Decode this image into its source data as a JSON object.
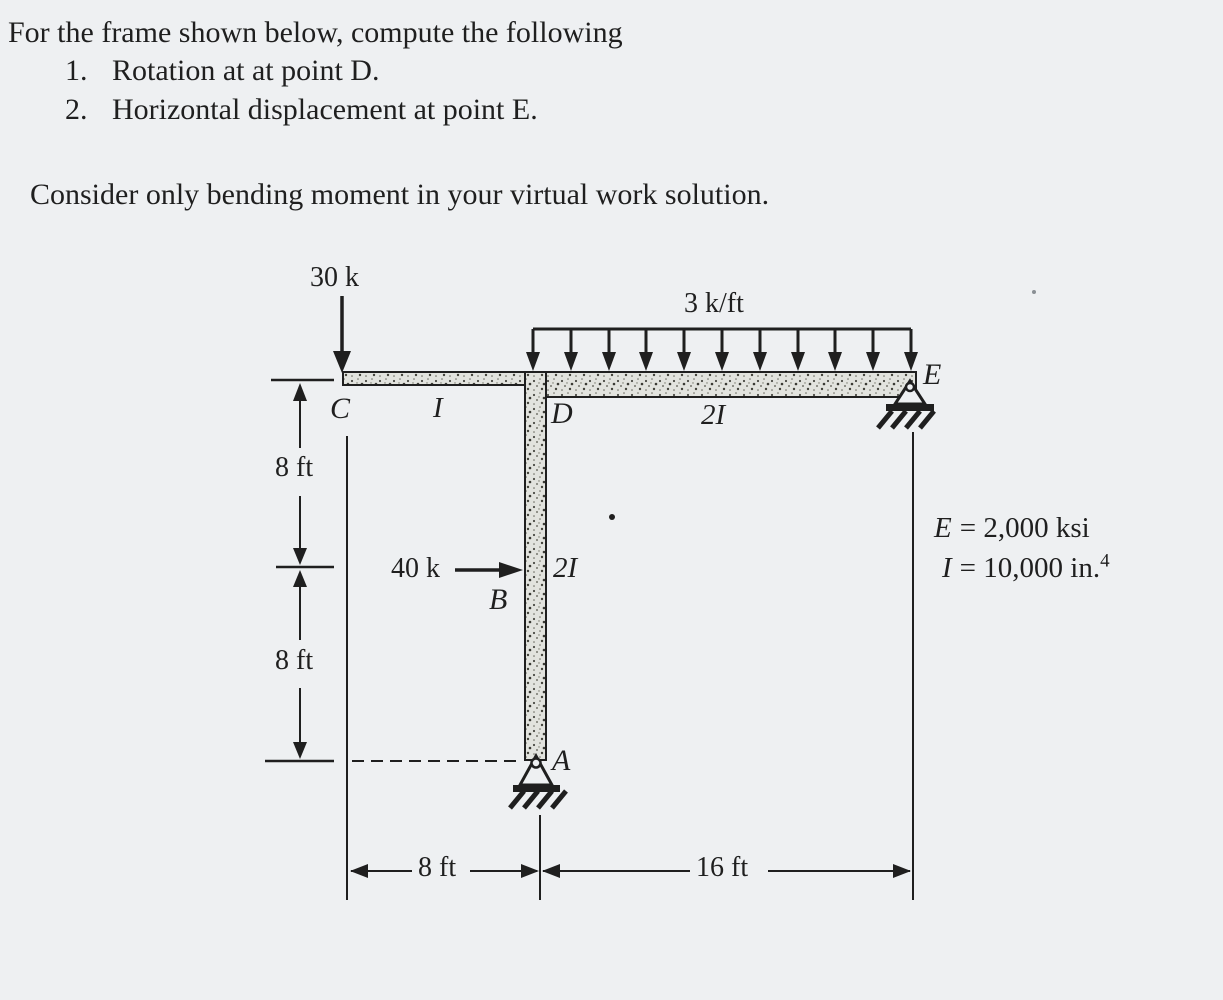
{
  "problem": {
    "intro": "For the frame shown below, compute the following",
    "items": [
      {
        "num": "1.",
        "text": "Rotation at at point D."
      },
      {
        "num": "2.",
        "text": "Horizontal displacement at point E."
      }
    ],
    "note": "Consider only bending moment in your virtual work solution."
  },
  "diagram": {
    "loads": {
      "top_point": "30 k",
      "distributed": "3 k/ft",
      "side_point": "40 k"
    },
    "nodes": {
      "c": "C",
      "d": "D",
      "e": "E",
      "b": "B",
      "a": "A"
    },
    "members": {
      "beam_left": "I",
      "beam_right": "2I",
      "column": "2I"
    },
    "dims": {
      "left_upper": "8 ft",
      "left_lower": "8 ft",
      "bottom_left": "8 ft",
      "bottom_right": "16 ft"
    },
    "properties": {
      "modulus_symbol": "E",
      "modulus_text": "= 2,000 ksi",
      "inertia_symbol": "I",
      "inertia_text": "= 10,000 in.",
      "inertia_sup": "4"
    },
    "colors": {
      "ink": "#1f1f1f",
      "paper": "#eef0f2",
      "member_fill": "#e2e3de"
    }
  }
}
